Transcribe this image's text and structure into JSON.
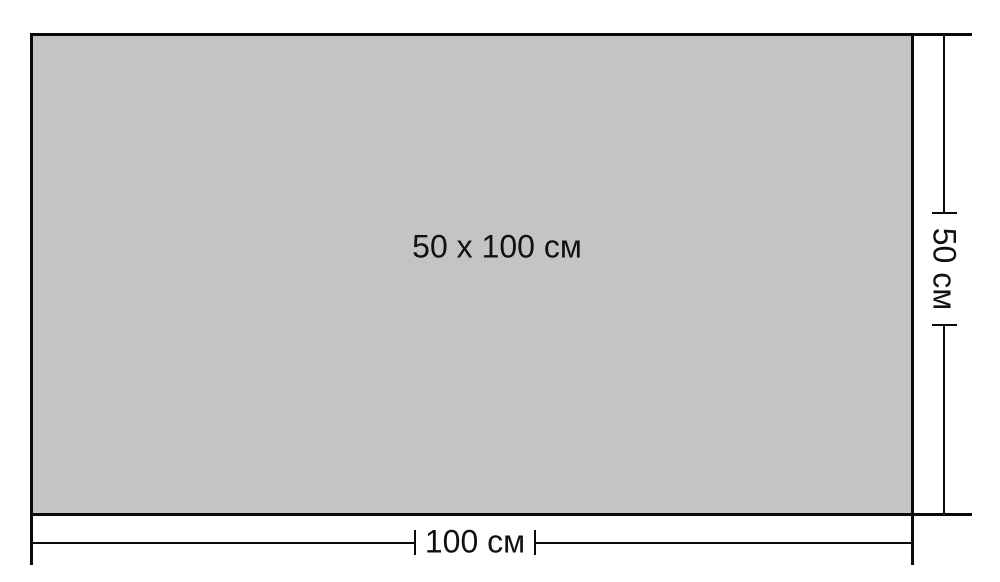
{
  "diagram": {
    "type": "dimension-drawing",
    "rectangle_label": "50 x 100 см",
    "bottom_dimension": {
      "label": "100 см"
    },
    "right_dimension": {
      "label": "50 см"
    },
    "colors": {
      "background": "#ffffff",
      "rectangle_fill": "#c4c4c4",
      "line": "#0a0a0a",
      "text": "#111111"
    }
  }
}
